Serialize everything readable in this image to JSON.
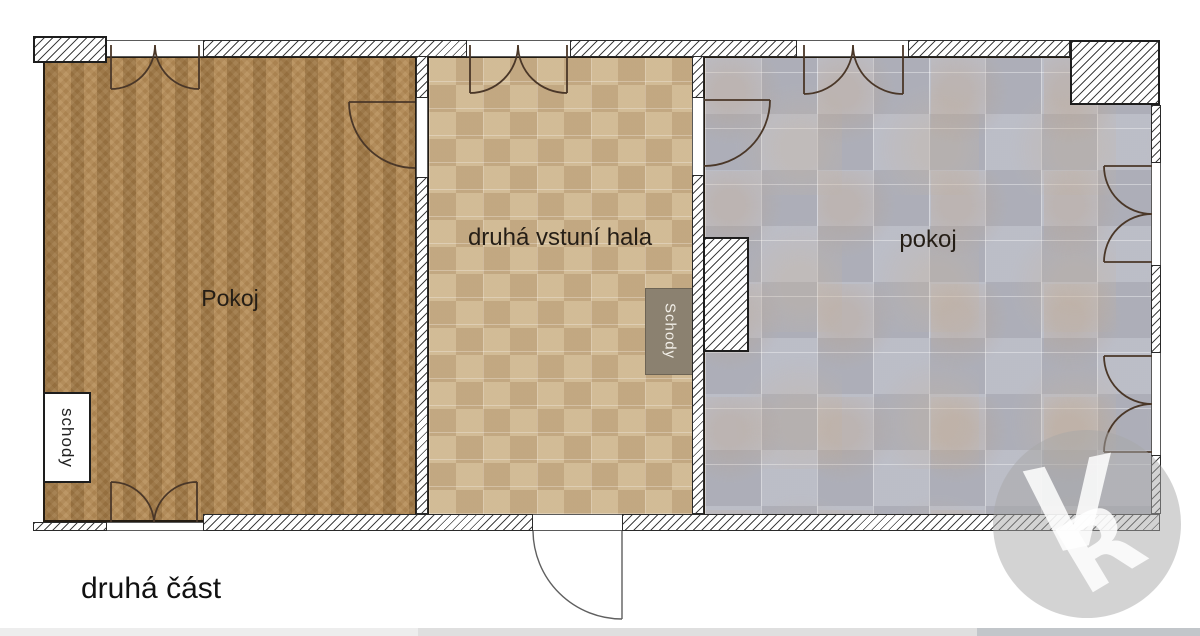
{
  "plan": {
    "caption": "druhá část",
    "rooms": [
      {
        "id": "room-left",
        "label": "Pokoj",
        "floor": "wood-herringbone"
      },
      {
        "id": "hall",
        "label": "druhá vstuní hala",
        "floor": "tan-tile"
      },
      {
        "id": "room-right",
        "label": "pokoj",
        "floor": "gray-tile"
      }
    ],
    "stairs": {
      "notch_label": "schody",
      "box_label": "Schody"
    }
  },
  "watermark": {
    "letter_v": "V",
    "letter_r": "R"
  },
  "colors": {
    "wood_floor": "#b18853",
    "tan_floor": "#cbb28c",
    "gray_floor": "#b4b6c0",
    "stairs_box": "#8b8170",
    "wall_outline": "#1d1d1d",
    "door_stroke": "#4a3728",
    "watermark_gray": "#c9c9c9"
  }
}
